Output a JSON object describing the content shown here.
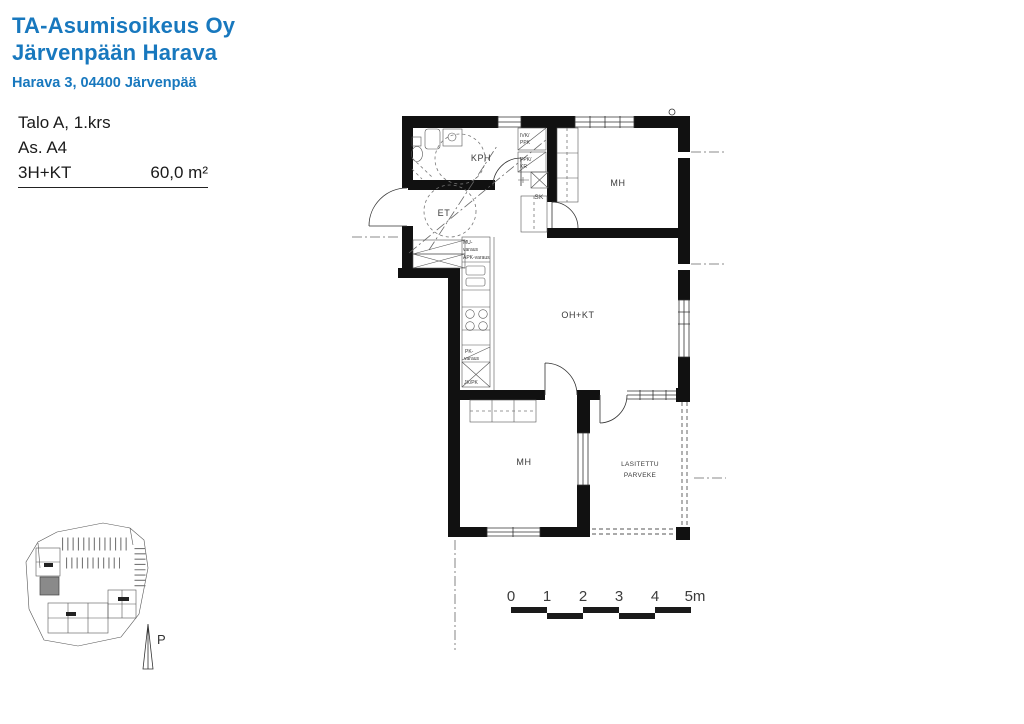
{
  "colors": {
    "accent": "#1878be",
    "wall": "#111111"
  },
  "header": {
    "company_line1": "TA-Asumisoikeus Oy",
    "company_line2": "Järvenpään Harava",
    "address": "Harava 3, 04400 Järvenpää"
  },
  "apartment": {
    "building_floor": "Talo A, 1.krs",
    "unit": "As. A4",
    "layout_type": "3H+KT",
    "area": "60,0 m²"
  },
  "floor_plan": {
    "rooms": {
      "bathroom": "KPH",
      "entry": "ET",
      "bedroom_top": "MH",
      "living_kitchen": "OH+KT",
      "bedroom_bottom": "MH",
      "balcony_line1": "LASITETTU",
      "balcony_line2": "PARVEKE",
      "cleaning_closet": "SK"
    },
    "appliances": {
      "ivk_ppk_line1": "IVK/",
      "ivk_ppk_line2": "PPK",
      "ppk_kr_line1": "PPK/",
      "ppk_kr_line2": "KR",
      "mu_line1": "MU-",
      "mu_line2": "varaus",
      "apk_varaus": "APK-varaus",
      "pk_line1": "PK-",
      "pk_line2": "varaus",
      "jk_pk": "JK/PK"
    }
  },
  "scale_bar": {
    "ticks": [
      "0",
      "1",
      "2",
      "3",
      "4",
      "5m"
    ]
  },
  "site_plan": {
    "north_label": "P"
  }
}
